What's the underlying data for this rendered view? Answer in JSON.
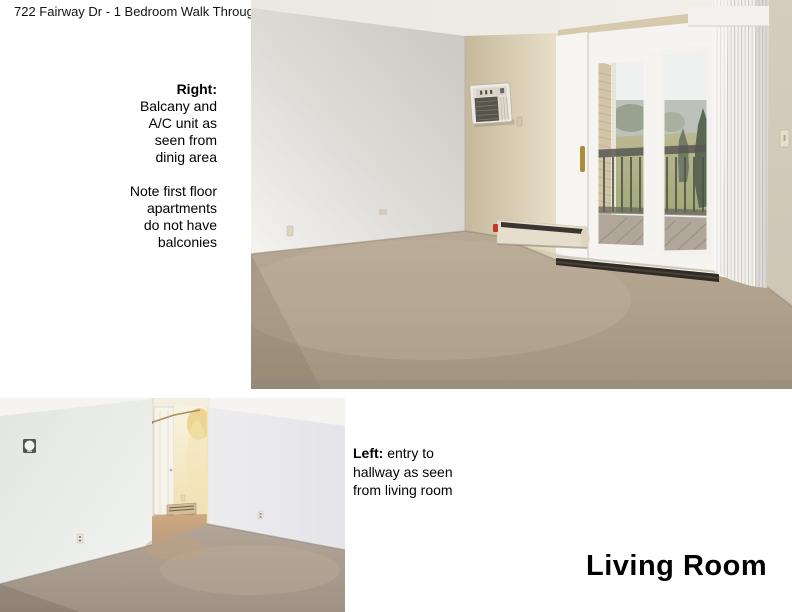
{
  "page": {
    "title": "722 Fairway Dr - 1 Bedroom Walk Through -",
    "section_title": "Living Room",
    "background": "#ffffff",
    "text_color": "#000000"
  },
  "annotations": {
    "right_note": {
      "lines": [
        "Right:",
        "Balcany and",
        "A/C unit as",
        "seen from",
        "dinig area",
        "",
        "Note first floor",
        "apartments",
        "do not have",
        "balconies"
      ]
    },
    "left_note": {
      "label": "Left:",
      "text": " entry to hallway as seen from living room"
    }
  },
  "photos": {
    "balcony_view": {
      "description": "Balcony and A/C unit as seen from dining area",
      "palette": {
        "wall_cream": "#ddd2bd",
        "wall_white": "#eceae6",
        "carpet": "#b1a28e",
        "trees": "#4d5b45",
        "grass": "#a9aa7c",
        "deck": "#ab9f92",
        "heater_red_cap": "#c0392b"
      }
    },
    "hallway_view": {
      "description": "Entry to hallway as seen from living room",
      "palette": {
        "wall_left": "#e8ebe8",
        "wall_right": "#e9e8ec",
        "hall_glow": "#eccf84",
        "hall_door": "#f4f0e4",
        "carpet": "#a89a8c"
      }
    }
  }
}
